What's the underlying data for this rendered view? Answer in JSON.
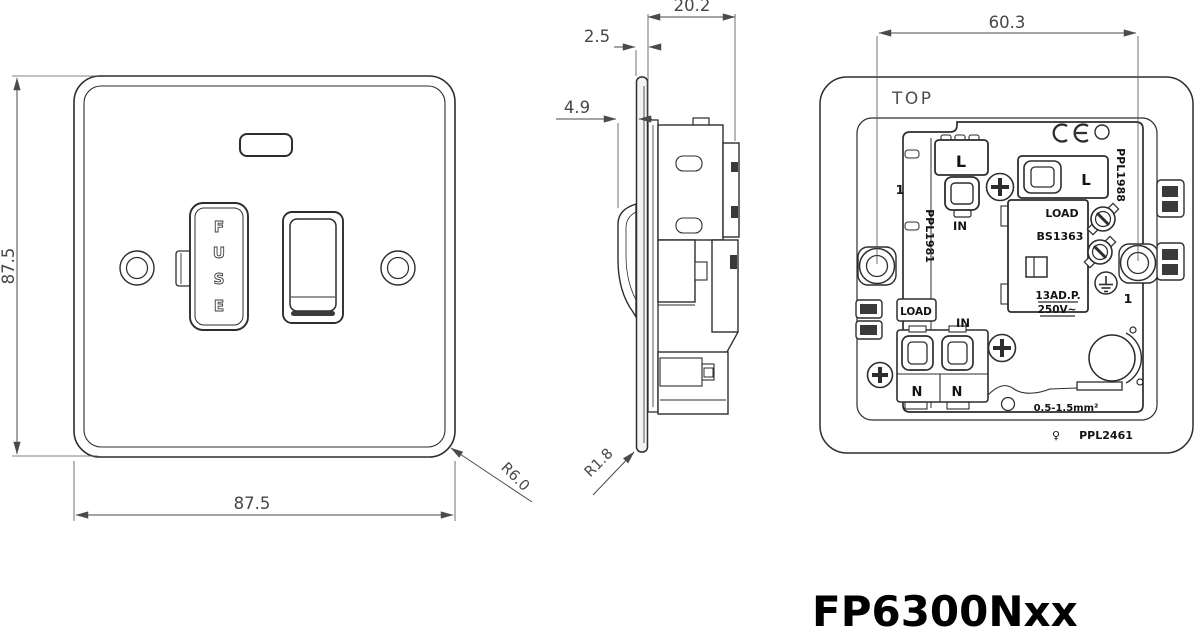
{
  "drawing": {
    "part_number": "FP6300Nxx",
    "front_view": {
      "dim_height_mm": "87.5",
      "dim_width_mm": "87.5",
      "corner_radius": "R6.0",
      "fuse_label_letters": [
        "F",
        "U",
        "S",
        "E"
      ]
    },
    "side_view": {
      "dim_depth_mm": "20.2",
      "dim_plate_thickness_mm": "2.5",
      "dim_switch_protrusion_mm": "4.9",
      "corner_radius": "R1.8"
    },
    "back_view": {
      "dim_fixing_centres_mm": "60.3",
      "orientation_label": "TOP",
      "ce_mark": "CE",
      "cavity_number_left": "1",
      "cavity_number_right": "1",
      "terminal_live_top": "L",
      "terminal_live_right": "L",
      "terminal_in_top": "IN",
      "terminal_in_bottom": "IN",
      "terminal_load_left": "LOAD",
      "terminal_neutral_1": "N",
      "terminal_neutral_2": "N",
      "fuse_carrier": {
        "load": "LOAD",
        "standard": "BS1363",
        "rating_line1": "13AD.P.",
        "rating_line2": "250V~"
      },
      "wire_capacity": "0.5-1.5mm²",
      "mould_ref_left": "PPL1981",
      "mould_ref_right": "PPL1988",
      "mould_ref_bottom": "PPL2461",
      "material_mark": "♀"
    },
    "colors": {
      "background": "#ffffff",
      "line": "#2d2d2d",
      "dimension": "#4a4a4a",
      "label_text": "#141414",
      "part_number_text": "#000000"
    }
  }
}
